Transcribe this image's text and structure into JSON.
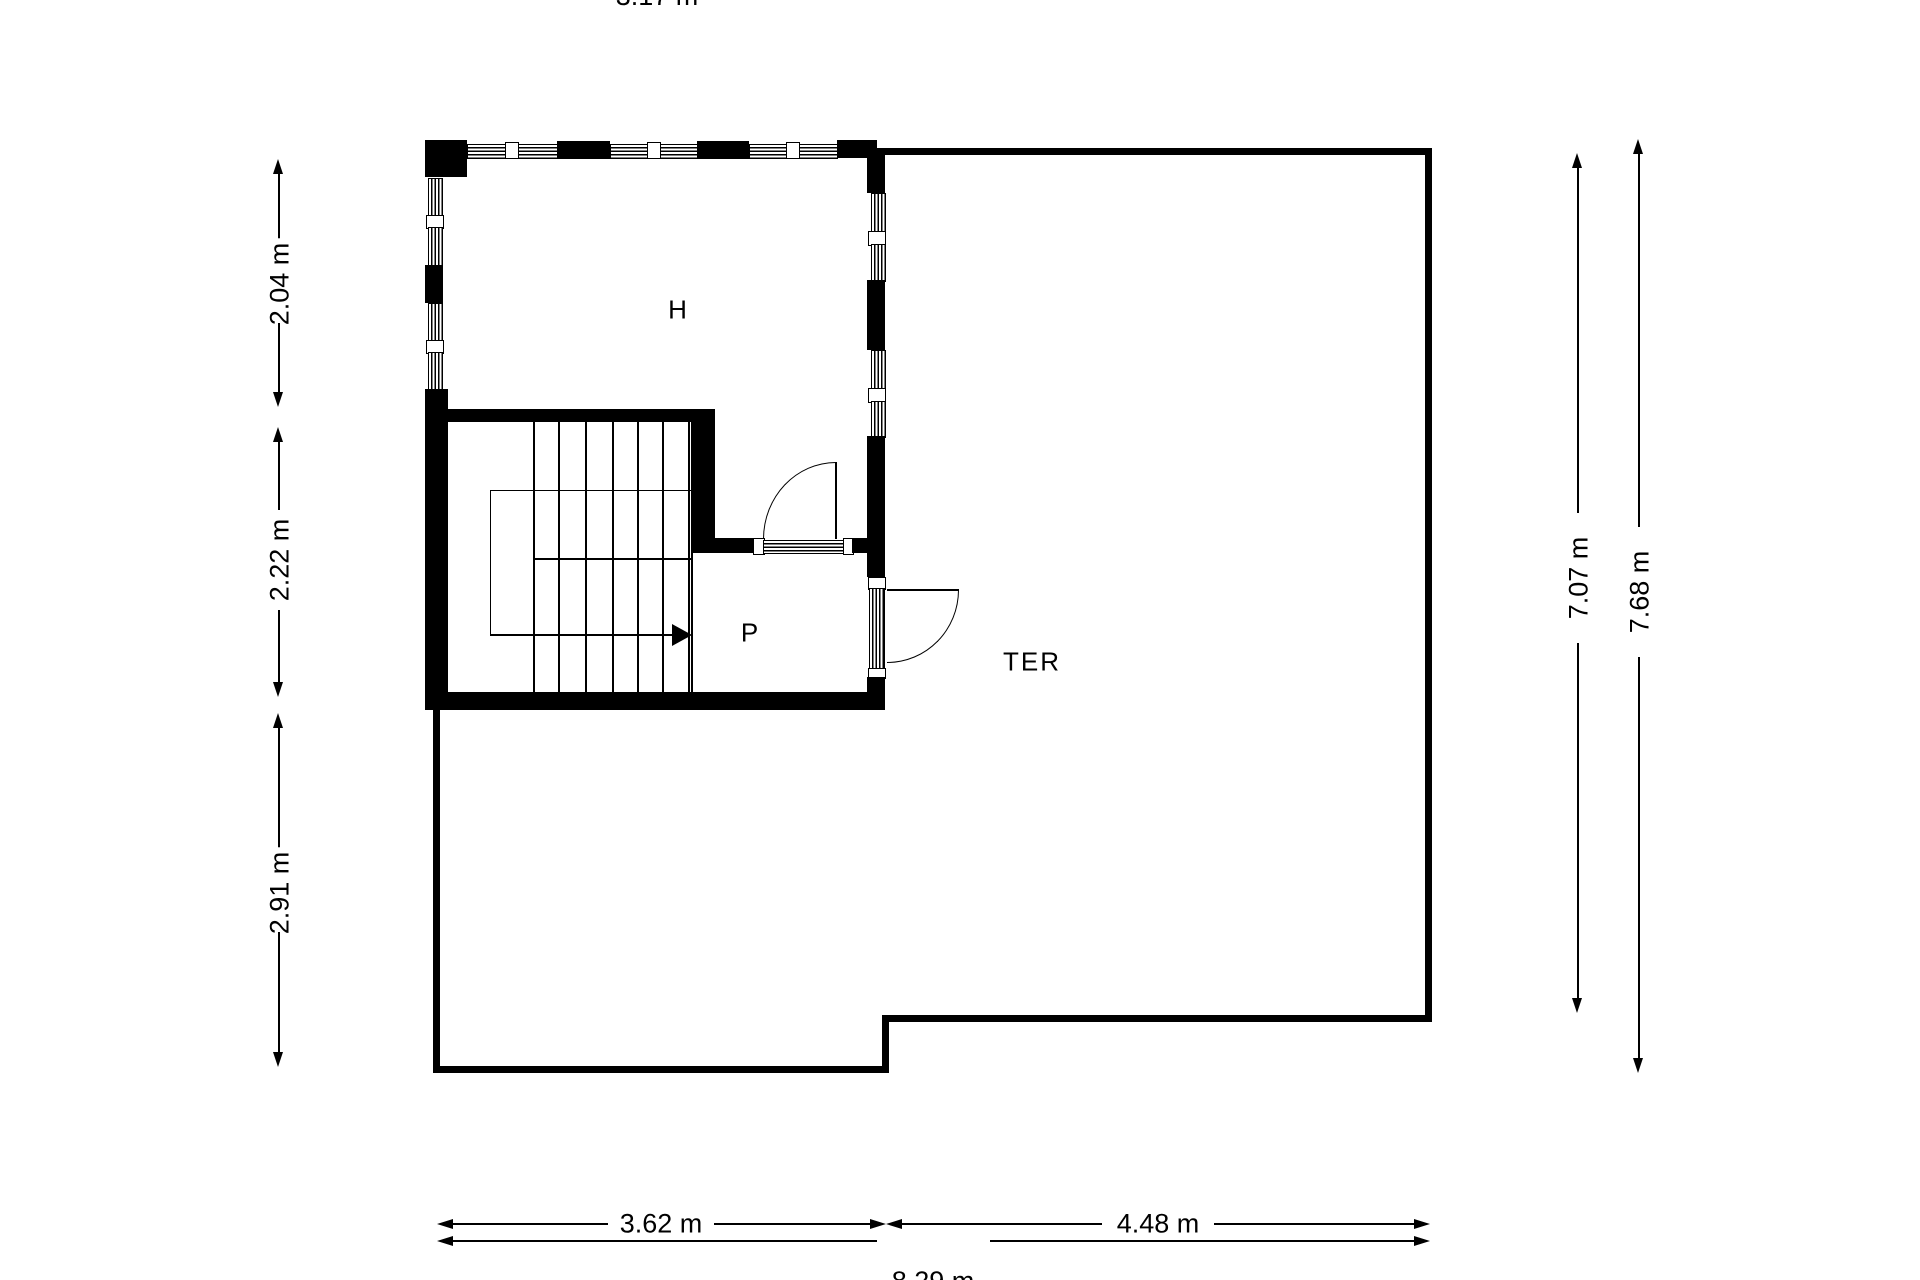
{
  "page": {
    "background": "#ffffff",
    "ink": "#000000"
  },
  "rooms": {
    "h": "H",
    "p": "P",
    "ter": "TER"
  },
  "dims": {
    "left_top": "2.04 m",
    "left_mid": "2.22 m",
    "left_bottom": "2.91 m",
    "right_inner": "7.07 m",
    "right_outer": "7.68 m",
    "bottom_left": "3.62 m",
    "bottom_right": "4.48 m",
    "bottom_total": "8.29 m",
    "top_left": "3.17 m",
    "top_right": "4.44 m"
  }
}
